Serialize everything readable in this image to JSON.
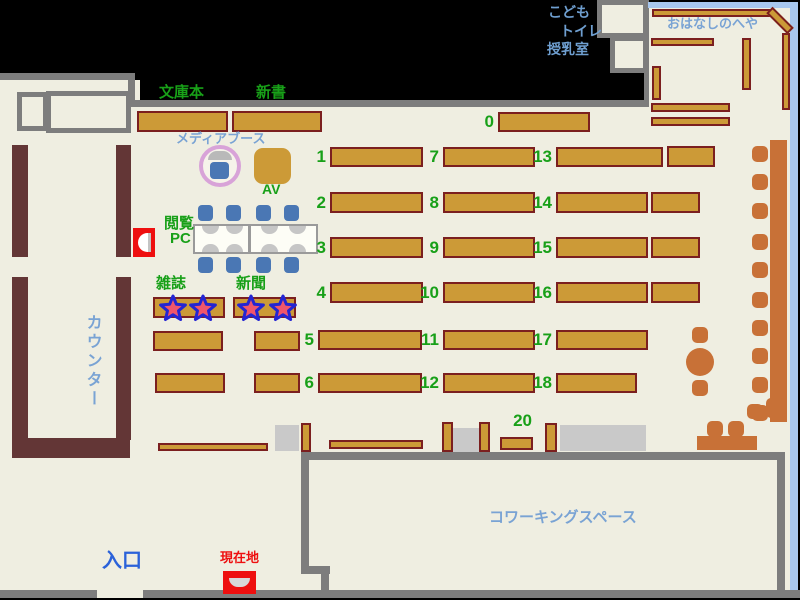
{
  "map": {
    "colors": {
      "floor": "#efeee1",
      "wall": "#7d7d7d",
      "shelf": "#cc9a37",
      "shelf_border": "#7b1f1f",
      "counter": "#633636",
      "furniture": "#c87137",
      "chair_blue": "#4a77b4",
      "block_gray": "#c9c9c9",
      "window": "#a8c7ee",
      "text_green": "#18a018",
      "text_lightblue": "#79a3d4",
      "text_blue": "#6f9fd0",
      "entrance_blue": "#2b62d9",
      "marker_red": "#ee0f0f",
      "star_fill": "#f0566b",
      "star_stroke": "#2425d2",
      "booth_ring": "#d8a3d8",
      "table_white": "#fdfdf6",
      "seat_gray": "#c6c6c6"
    },
    "labels": {
      "bunkobon": "文庫本",
      "shinsho": "新書",
      "media_booth": "メディアブース",
      "av": "AV",
      "reading_pc_line1": "閲覧",
      "reading_pc_line2": "PC",
      "zasshi": "雑誌",
      "shinbun": "新聞",
      "counter": "カウンター",
      "kodomo": "こども",
      "toilet": "トイレ",
      "nursing": "授乳室",
      "ohanashi": "おはなしのへや",
      "coworking": "コワーキングスペース",
      "entrance": "入口",
      "current_location": "現在地"
    },
    "shelves": {
      "numbered": [
        {
          "n": "0",
          "x": 498,
          "y": 112,
          "w": 92,
          "h": 20,
          "lx": 480,
          "ly": 112
        },
        {
          "n": "1",
          "x": 330,
          "y": 147,
          "w": 93,
          "h": 20,
          "lx": 310,
          "ly": 147
        },
        {
          "n": "2",
          "x": 330,
          "y": 192,
          "w": 93,
          "h": 21,
          "lx": 310,
          "ly": 192
        },
        {
          "n": "3",
          "x": 330,
          "y": 237,
          "w": 93,
          "h": 21,
          "lx": 310,
          "ly": 237
        },
        {
          "n": "4",
          "x": 330,
          "y": 282,
          "w": 93,
          "h": 21,
          "lx": 310,
          "ly": 282
        },
        {
          "n": "5",
          "x": 318,
          "y": 330,
          "w": 104,
          "h": 20,
          "lx": 298,
          "ly": 330
        },
        {
          "n": "6",
          "x": 318,
          "y": 373,
          "w": 104,
          "h": 20,
          "lx": 298,
          "ly": 373
        },
        {
          "n": "7",
          "x": 443,
          "y": 147,
          "w": 92,
          "h": 20,
          "lx": 423,
          "ly": 147
        },
        {
          "n": "8",
          "x": 443,
          "y": 192,
          "w": 92,
          "h": 21,
          "lx": 423,
          "ly": 192
        },
        {
          "n": "9",
          "x": 443,
          "y": 237,
          "w": 92,
          "h": 21,
          "lx": 423,
          "ly": 237
        },
        {
          "n": "10",
          "x": 443,
          "y": 282,
          "w": 92,
          "h": 21,
          "lx": 415,
          "ly": 282
        },
        {
          "n": "11",
          "x": 443,
          "y": 330,
          "w": 92,
          "h": 20,
          "lx": 415,
          "ly": 330
        },
        {
          "n": "12",
          "x": 443,
          "y": 373,
          "w": 92,
          "h": 20,
          "lx": 415,
          "ly": 373
        },
        {
          "n": "13",
          "x": 556,
          "y": 147,
          "w": 107,
          "h": 20,
          "lx": 528,
          "ly": 147
        },
        {
          "n": "14",
          "x": 556,
          "y": 192,
          "w": 92,
          "h": 21,
          "lx": 528,
          "ly": 192
        },
        {
          "n": "15",
          "x": 556,
          "y": 237,
          "w": 92,
          "h": 21,
          "lx": 528,
          "ly": 237
        },
        {
          "n": "16",
          "x": 556,
          "y": 282,
          "w": 92,
          "h": 21,
          "lx": 528,
          "ly": 282
        },
        {
          "n": "17",
          "x": 556,
          "y": 330,
          "w": 92,
          "h": 20,
          "lx": 528,
          "ly": 330
        },
        {
          "n": "18",
          "x": 556,
          "y": 373,
          "w": 81,
          "h": 20,
          "lx": 528,
          "ly": 373
        },
        {
          "n": "20",
          "x": 500,
          "y": 437,
          "w": 33,
          "h": 13,
          "lx": 502,
          "ly": 414,
          "lw": 30
        }
      ],
      "plain": [
        [
          137,
          111,
          91,
          21
        ],
        [
          232,
          111,
          90,
          21
        ],
        [
          153,
          297,
          72,
          21
        ],
        [
          233,
          297,
          63,
          21
        ],
        [
          153,
          331,
          70,
          20
        ],
        [
          254,
          331,
          46,
          20
        ],
        [
          155,
          373,
          70,
          20
        ],
        [
          254,
          373,
          46,
          20
        ],
        [
          667,
          146,
          48,
          21
        ],
        [
          651,
          192,
          49,
          21
        ],
        [
          651,
          237,
          49,
          21
        ],
        [
          651,
          282,
          49,
          21
        ],
        [
          158,
          443,
          110,
          8
        ],
        [
          329,
          440,
          94,
          9
        ],
        [
          301,
          423,
          10,
          29
        ],
        [
          442,
          422,
          11,
          30
        ],
        [
          479,
          422,
          11,
          30
        ],
        [
          545,
          423,
          12,
          29
        ],
        [
          652,
          9,
          118,
          8
        ],
        [
          651,
          38,
          63,
          8
        ],
        [
          742,
          38,
          9,
          52
        ],
        [
          652,
          66,
          9,
          34
        ],
        [
          651,
          103,
          79,
          9
        ],
        [
          651,
          117,
          79,
          9
        ],
        [
          782,
          33,
          8,
          77
        ],
        [
          765,
          16,
          30,
          9,
          45
        ]
      ]
    },
    "gray_blocks": [
      [
        275,
        425,
        24,
        26
      ],
      [
        453,
        428,
        26,
        24
      ],
      [
        560,
        425,
        86,
        26
      ]
    ],
    "chairs": {
      "blue": [
        [
          198,
          205
        ],
        [
          226,
          205
        ],
        [
          256,
          205
        ],
        [
          284,
          205
        ],
        [
          198,
          257
        ],
        [
          226,
          257
        ],
        [
          256,
          257
        ],
        [
          284,
          257
        ]
      ],
      "orange": [
        [
          752,
          146
        ],
        [
          752,
          174
        ],
        [
          752,
          203
        ],
        [
          752,
          234
        ],
        [
          752,
          262
        ],
        [
          752,
          292
        ],
        [
          752,
          320
        ],
        [
          752,
          348
        ],
        [
          752,
          377
        ],
        [
          752,
          405
        ],
        [
          692,
          327
        ],
        [
          692,
          380
        ],
        [
          707,
          421
        ],
        [
          728,
          421
        ],
        [
          747,
          404,
          16,
          15
        ],
        [
          766,
          398,
          20,
          20
        ]
      ]
    },
    "stars": [
      [
        173,
        308
      ],
      [
        203,
        308
      ],
      [
        251,
        308
      ],
      [
        283,
        308
      ]
    ],
    "star_points": "15,3 18.4,11.3 27.4,12 20.5,17.8 22.6,26.5 15,21.8 7.4,26.5 9.5,17.8 2.6,12 11.6,11.3"
  }
}
